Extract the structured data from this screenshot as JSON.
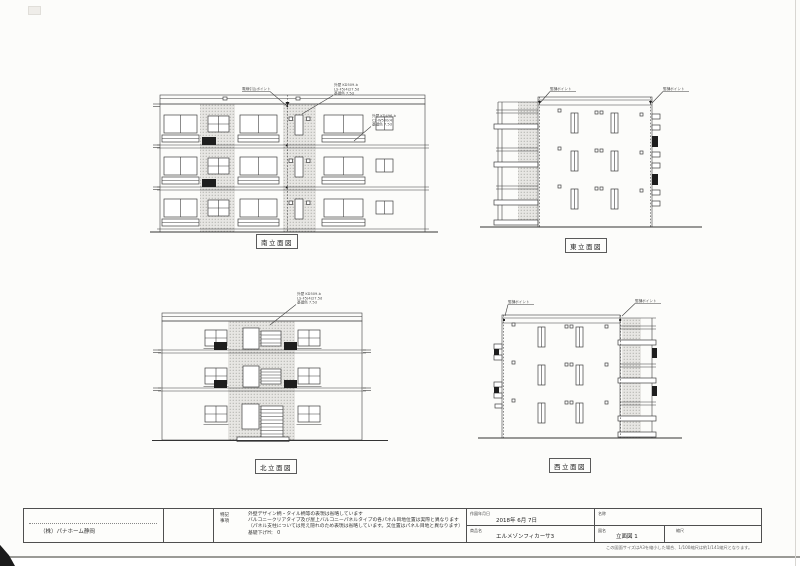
{
  "sheet": {
    "footnote": "この図面サイズはA3を縮小した場合、1/100縮尺は約1/141縮尺となります。"
  },
  "drawings": {
    "south": {
      "label": "南立面図",
      "ann_wire": "電線引込ポイント",
      "spec1": [
        "外壁 KD509-b",
        "LS-F5(4)27.5d",
        "基礎色 7.5d"
      ],
      "spec2": [
        "外壁 KD496-b",
        "C2-W500(4)",
        "基礎色 7.5d"
      ]
    },
    "east": {
      "label": "東立面図",
      "ann_left": "竪樋ポイント",
      "ann_right": "竪樋ポイント"
    },
    "north": {
      "label": "北立面図",
      "spec": [
        "外壁 KD509-b",
        "LS-F5(4)27.5d",
        "基礎色 7.5d"
      ]
    },
    "west": {
      "label": "西立面図",
      "ann_left": "竪樋ポイント",
      "ann_right": "竪樋ポイント"
    }
  },
  "titleblock": {
    "company": "（株）パナホーム静岡",
    "notes_label": "特記事項",
    "notes": [
      "外壁デザイン柄・タイル柄等の表現は省略しています",
      "バルコニークリアタイプ及び屋上バルコニーパネルタイプの各パネル目地位置は実際と異なります",
      "（パネル支柱については見え隠れのため表現は省略しています。又位置はパネル目地と異なります）",
      "基礎下げH： 0"
    ],
    "date_label": "作図年月日",
    "date_value": "2018年 6月 7日",
    "name_label": "名称",
    "name_value": "",
    "product_label": "商品名",
    "product_value": "エルメゾンフィカーサ3",
    "sheet_label": "図名",
    "sheet_value": "立面図 1",
    "scale_label": "縮尺",
    "scale_value": ""
  }
}
